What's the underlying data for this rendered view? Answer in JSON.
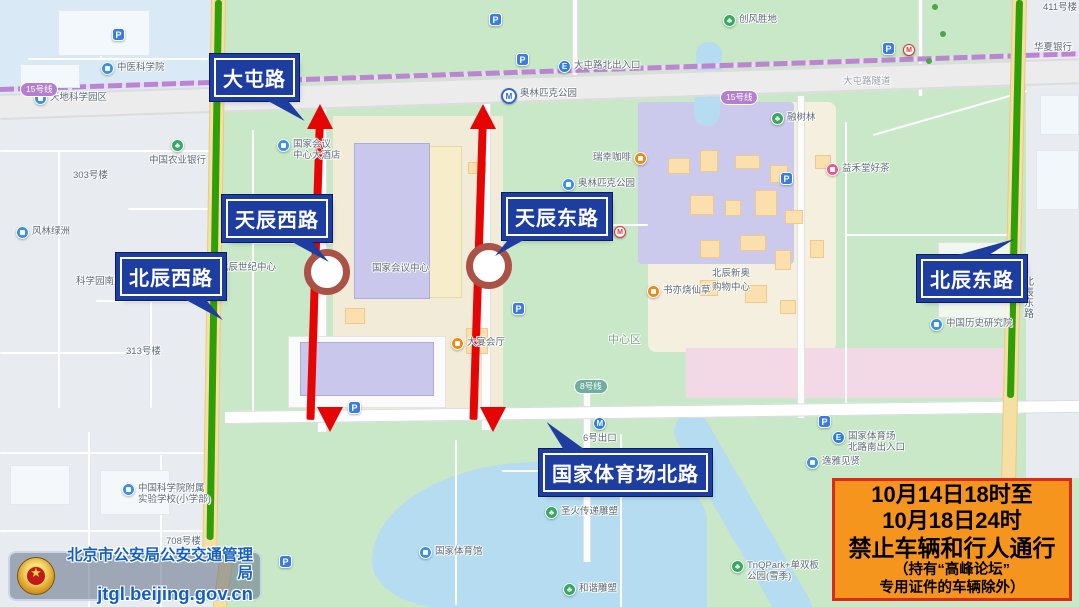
{
  "map": {
    "pois": [
      {
        "t": "blue",
        "x": 101,
        "y": 62,
        "l": "中医科学院"
      },
      {
        "t": "blue",
        "x": 34,
        "y": 92,
        "l": "天地科学园区"
      },
      {
        "t": "blue",
        "x": 16,
        "y": 226,
        "l": "风林绿洲"
      },
      {
        "t": "blue",
        "x": 76,
        "y": 276,
        "l": "科学园南里",
        "pre": true
      },
      {
        "t": "blue",
        "x": 277,
        "y": 139,
        "l": "国家会议",
        "l2": "中心大酒店"
      },
      {
        "t": "blue",
        "x": 203,
        "y": 262,
        "l": "北辰世纪中心"
      },
      {
        "t": "blue",
        "x": 419,
        "y": 546,
        "l": "国家体育馆"
      },
      {
        "t": "blue",
        "x": 806,
        "y": 456,
        "l": "逸雅见贤"
      },
      {
        "t": "blue",
        "x": 930,
        "y": 318,
        "l": "中国历史研究院"
      },
      {
        "t": "blue",
        "x": 122,
        "y": 483,
        "l": "中国科学院附属",
        "l2": "实验学校(小学部)"
      },
      {
        "t": "blue",
        "x": 562,
        "y": 178,
        "l": "奥林匹克公园"
      },
      {
        "t": "station",
        "x": 501,
        "y": 88,
        "l": "奥林匹克公园"
      },
      {
        "t": "metroB",
        "x": 583,
        "y": 417,
        "l": "6号出口",
        "below": true
      },
      {
        "t": "metroE",
        "x": 832,
        "y": 431,
        "l": "国家体育场",
        "l2": "北路南出入口"
      },
      {
        "t": "metroE",
        "x": 558,
        "y": 60,
        "l": "大屯路北出入口"
      },
      {
        "t": "green",
        "x": 149,
        "y": 139,
        "l": "中国农业银行",
        "below": true
      },
      {
        "t": "green",
        "x": 723,
        "y": 14,
        "l": "创风胜地"
      },
      {
        "t": "green",
        "x": 771,
        "y": 112,
        "l": "融树林"
      },
      {
        "t": "green",
        "x": 545,
        "y": 506,
        "l": "圣火传递雕塑"
      },
      {
        "t": "green",
        "x": 563,
        "y": 583,
        "l": "和谐雕塑"
      },
      {
        "t": "green",
        "x": 731,
        "y": 560,
        "l": "TnQPark+单双板",
        "l2": "公园(雪季)"
      },
      {
        "t": "orange",
        "x": 593,
        "y": 152,
        "l": "瑞幸咖啡",
        "pre": true
      },
      {
        "t": "orange",
        "x": 647,
        "y": 285,
        "l": "书亦烧仙草"
      },
      {
        "t": "orange",
        "x": 451,
        "y": 337,
        "l": "大宴会厅"
      },
      {
        "t": "pink",
        "x": 826,
        "y": 163,
        "l": "益禾堂好茶"
      },
      {
        "t": "parking",
        "x": 112,
        "y": 28
      },
      {
        "t": "parking",
        "x": 489,
        "y": 13
      },
      {
        "t": "parking",
        "x": 516,
        "y": 53
      },
      {
        "t": "parking",
        "x": 348,
        "y": 401
      },
      {
        "t": "parking",
        "x": 780,
        "y": 172
      },
      {
        "t": "parking",
        "x": 818,
        "y": 415
      },
      {
        "t": "parking",
        "x": 279,
        "y": 555
      },
      {
        "t": "parking",
        "x": 512,
        "y": 302
      },
      {
        "t": "parking",
        "x": 882,
        "y": 42
      },
      {
        "t": "metroM",
        "x": 614,
        "y": 226
      },
      {
        "t": "metroM",
        "x": 903,
        "y": 44
      },
      {
        "t": "text",
        "x": 73,
        "y": 170,
        "l": "303号楼"
      },
      {
        "t": "text",
        "x": 126,
        "y": 346,
        "l": "313号楼"
      },
      {
        "t": "text",
        "x": 166,
        "y": 536,
        "l": "708号楼"
      },
      {
        "t": "text",
        "x": 1043,
        "y": 2,
        "l": "411号楼"
      },
      {
        "t": "text",
        "x": 1034,
        "y": 42,
        "l": "华夏银行"
      },
      {
        "t": "roadname",
        "x": 843,
        "y": 76,
        "l": "大屯路隧道"
      },
      {
        "t": "area",
        "x": 608,
        "y": 335,
        "l": "中心区"
      },
      {
        "t": "text",
        "x": 712,
        "y": 268,
        "l": "北辰新奥"
      },
      {
        "t": "text",
        "x": 712,
        "y": 282,
        "l": "购物中心"
      },
      {
        "t": "text",
        "x": 372,
        "y": 263,
        "l": "国家会议中心"
      },
      {
        "t": "vtext",
        "x": 1024,
        "y": 278,
        "l": "北辰东路"
      },
      {
        "t": "pill15",
        "x": 20,
        "y": 82,
        "l": "15号线"
      },
      {
        "t": "pill15",
        "x": 720,
        "y": 90,
        "l": "15号线"
      },
      {
        "t": "pill8",
        "x": 574,
        "y": 379,
        "l": "8号线"
      }
    ],
    "callouts": [
      {
        "l": "大屯路",
        "x": 214,
        "y": 58,
        "tail": "dr"
      },
      {
        "l": "天辰西路",
        "x": 226,
        "y": 199,
        "tail": "dr"
      },
      {
        "l": "天辰东路",
        "x": 506,
        "y": 197,
        "tail": "dl"
      },
      {
        "l": "北辰西路",
        "x": 120,
        "y": 257,
        "tail": "dr"
      },
      {
        "l": "北辰东路",
        "x": 921,
        "y": 259,
        "tail": "ur"
      },
      {
        "l": "国家体育场北路",
        "x": 543,
        "y": 453,
        "tail": "ul"
      }
    ],
    "arrows": [
      {
        "x": 320,
        "y1": 104,
        "y2": 432,
        "cx": 327,
        "cy": 272,
        "road": "天辰西路"
      },
      {
        "x": 483,
        "y1": 104,
        "y2": 432,
        "cx": 489,
        "cy": 266,
        "road": "天辰东路"
      }
    ]
  },
  "notice": {
    "lines": [
      "10月14日18时至",
      "10月18日24时",
      "禁止车辆和行人通行",
      "（持有“高峰论坛”",
      "专用证件的车辆除外）"
    ]
  },
  "banner": {
    "agency": "北京市公安局公安交通管理局",
    "url": "jtgl.beijing.gov.cn"
  },
  "colors": {
    "closed_road_red": "#e60505",
    "open_road_green": "#2ea006",
    "callout_blue": "#1d3da1",
    "notice_bg": "#f6951d",
    "notice_border": "#da2b18"
  }
}
